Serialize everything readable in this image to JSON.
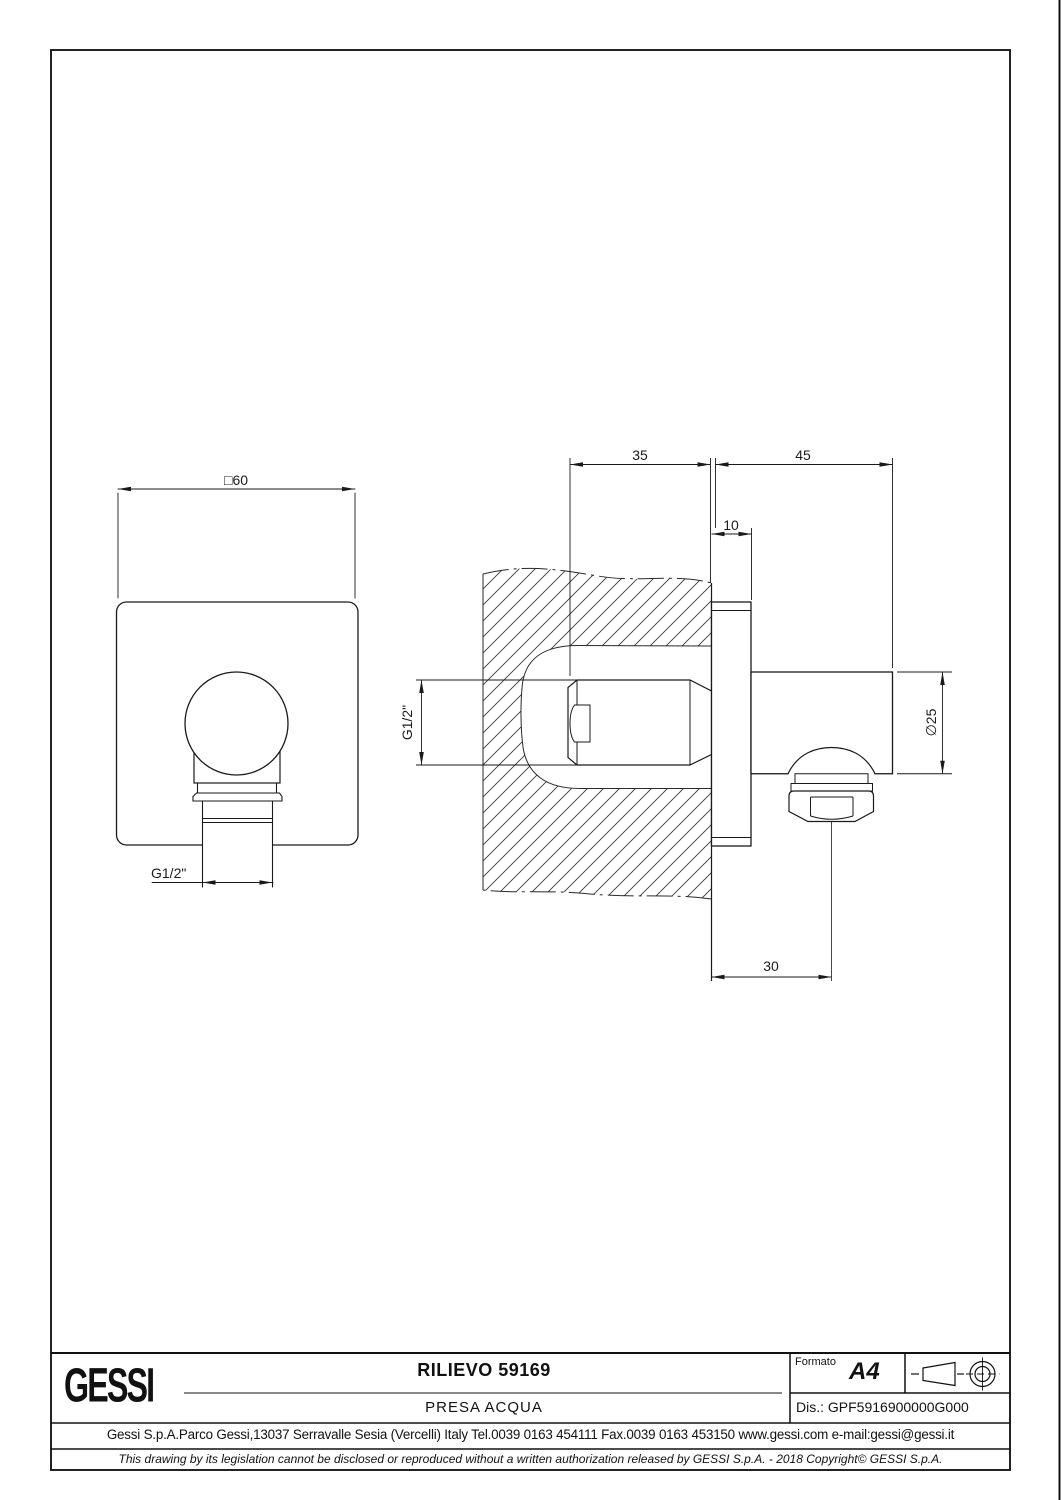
{
  "page": {
    "background": "#ffffff",
    "line_color": "#1a1a1a",
    "frame_color": "#6a6a6a"
  },
  "views": {
    "front": {
      "width_dim": "□60",
      "thread_dim": "G1/2\""
    },
    "section": {
      "embed_depth_dim": "35",
      "projection_dim": "45",
      "plate_thickness_dim": "10",
      "thread_dim": "G1/2\"",
      "diameter_dim": "∅25",
      "outlet_offset_dim": "30"
    }
  },
  "title_block": {
    "logo_text": "GESSI",
    "drawing_title": "RILIEVO 59169",
    "drawing_subtitle": "PRESA  ACQUA",
    "format_label": "Formato",
    "format_value": "A4",
    "drawing_number": "Dis.: GPF5916900000G000",
    "projection_icon": "first-angle-projection",
    "address_line": "Gessi S.p.A.Parco Gessi,13037 Serravalle Sesia (Vercelli) Italy Tel.0039 0163 454111 Fax.0039 0163 453150 www.gessi.com e-mail:gessi@gessi.it",
    "disclaimer_line": "This drawing by its legislation cannot be disclosed or reproduced without a written authorization released by GESSI S.p.A. - 2018 Copyright© GESSI S.p.A."
  }
}
